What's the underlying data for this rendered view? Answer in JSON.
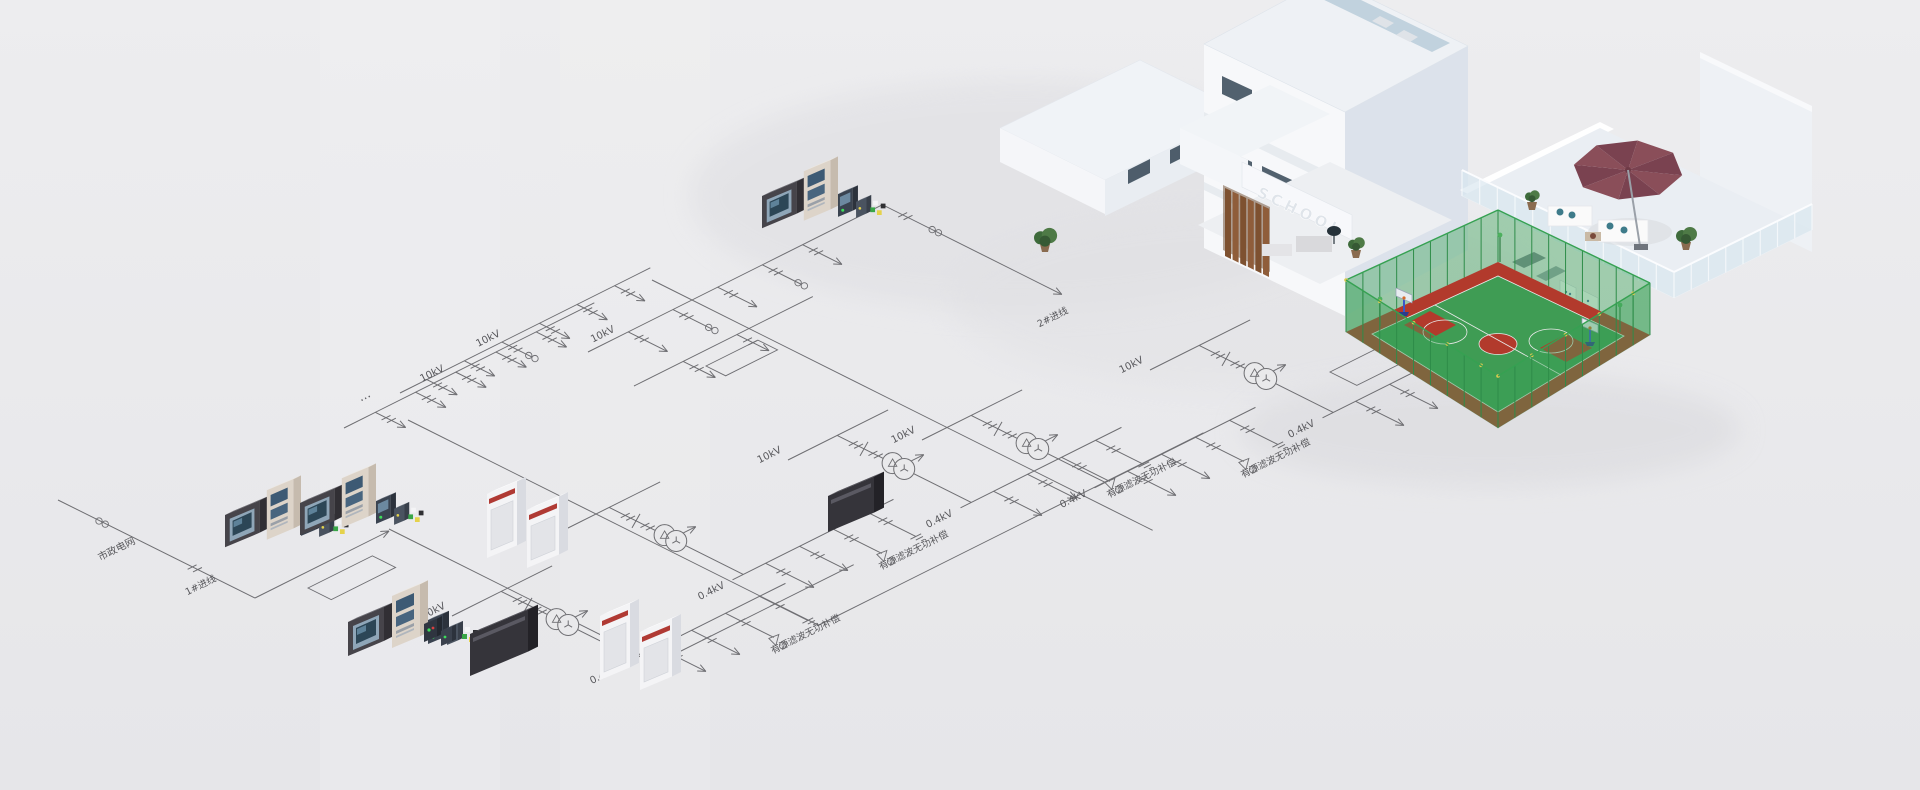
{
  "scene": {
    "background_top": "#ededef",
    "background_bottom": "#e6e6e9"
  },
  "building": {
    "sign": "SCHOOL",
    "court_green": "#3f9c54",
    "court_red": "#b23a2c",
    "fence_green": "#3aa257",
    "umbrella_color": "#8a4e59",
    "wood_color": "#7e5130"
  },
  "diagram": {
    "stroke": "#6e6e72",
    "text_color": "#57575b",
    "groups": [
      {
        "x": 452,
        "y": 610,
        "hv": "10kV",
        "lv": "0.4kV",
        "f1": "有源滤波",
        "f2": "无功补偿"
      },
      {
        "x": 560,
        "y": 526,
        "hv": "10kV",
        "lv": "0.4kV",
        "f1": "有源滤波",
        "f2": "无功补偿"
      },
      {
        "x": 788,
        "y": 454,
        "hv": "10kV",
        "lv": "0.4kV",
        "f1": "有源滤波",
        "f2": "无功补偿"
      },
      {
        "x": 922,
        "y": 434,
        "hv": "10kV",
        "lv": "0.4kV",
        "f1": "有源滤波",
        "f2": "无功补偿"
      },
      {
        "x": 1150,
        "y": 364,
        "hv": "10kV",
        "lv": "0.4kV",
        "f1": "有源滤波",
        "f2": "无功补偿"
      }
    ],
    "buses": [
      {
        "x": 588,
        "y": 352,
        "len": 330,
        "label": "10kV",
        "label_off": 18,
        "drops": [
          45,
          95,
          145,
          195,
          240
        ],
        "dlen": 44,
        "ct": [
          1,
          3
        ]
      },
      {
        "x": 634,
        "y": 386,
        "len": 200,
        "label": "",
        "drops": [
          55,
          115
        ],
        "dlen": 36,
        "ct": []
      },
      {
        "x": 400,
        "y": 393,
        "len": 280,
        "label": "10kV",
        "label_off": 100,
        "drops": [
          30,
          72,
          114,
          156,
          198,
          240
        ],
        "dlen": 34,
        "ct": [
          2
        ]
      },
      {
        "x": 344,
        "y": 428,
        "len": 280,
        "label": "10kV",
        "label_off": 100,
        "drops": [
          35,
          80,
          125,
          170,
          215
        ],
        "dlen": 34,
        "ct": []
      }
    ],
    "trunks": [
      {
        "x": 408,
        "y": 420,
        "axis": "R",
        "len": 460
      },
      {
        "x": 819,
        "y": 625,
        "axis": "Q",
        "len": 430
      },
      {
        "x": 652,
        "y": 280,
        "axis": "R",
        "len": 560
      },
      {
        "x": 389,
        "y": 529,
        "axis": "R",
        "len": 300
      },
      {
        "x": 657,
        "y": 663,
        "axis": "Q",
        "len": 220
      }
    ],
    "loops": [
      {
        "x": 308,
        "y": 588,
        "lq": 72,
        "lr": 26
      },
      {
        "x": 1330,
        "y": 372,
        "lq": 110,
        "lr": 30
      },
      {
        "x": 706,
        "y": 366,
        "lq": 58,
        "lr": 22
      }
    ],
    "incoming": {
      "points": [
        [
          58,
          500
        ],
        [
          255,
          598
        ],
        [
          389,
          531
        ]
      ],
      "label": "市政电网",
      "label_x": 118,
      "label_y": 552,
      "sub_label": "1#进线",
      "sub_x": 202,
      "sub_y": 588
    },
    "incoming2": {
      "x": 883,
      "y": 205,
      "len": 200,
      "label": "2#进线",
      "label_x": 1054,
      "label_y": 320
    },
    "annotations": [
      {
        "text": "…",
        "x": 366,
        "y": 399
      }
    ],
    "clusters": [
      {
        "type": "meter-set",
        "x": 225,
        "y": 515,
        "s": 0.95
      },
      {
        "type": "meter-set",
        "x": 300,
        "y": 503,
        "s": 0.95
      },
      {
        "type": "meter-set",
        "x": 348,
        "y": 622,
        "s": 1
      },
      {
        "type": "meter-set",
        "x": 762,
        "y": 196,
        "s": 0.95
      },
      {
        "type": "switchgear-pair",
        "x": 487,
        "y": 494
      },
      {
        "type": "switchgear-pair",
        "x": 600,
        "y": 616
      },
      {
        "type": "dark-cabinet",
        "x": 470,
        "y": 634,
        "w": 58,
        "h": 42
      },
      {
        "type": "dark-cabinet",
        "x": 828,
        "y": 496,
        "w": 46,
        "h": 36
      },
      {
        "type": "mini-panels",
        "x": 424,
        "y": 624
      }
    ]
  }
}
